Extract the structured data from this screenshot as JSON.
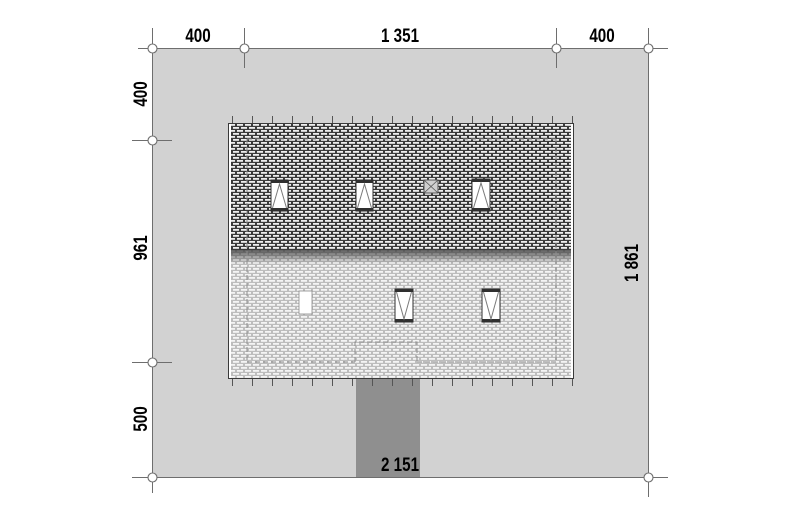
{
  "drawing": {
    "type": "architectural-site-plan",
    "dimensions": {
      "top": [
        "400",
        "1 351",
        "400"
      ],
      "left": [
        "400",
        "961",
        "500"
      ],
      "right": [
        "1 861"
      ],
      "bottom": [
        "2 151"
      ]
    },
    "colors": {
      "site_fill": "#d2d2d2",
      "driveway_fill": "#8f8f8f",
      "line": "#6e6e6e",
      "roof_edge": "#3a3a3a",
      "text": "#000000"
    }
  }
}
